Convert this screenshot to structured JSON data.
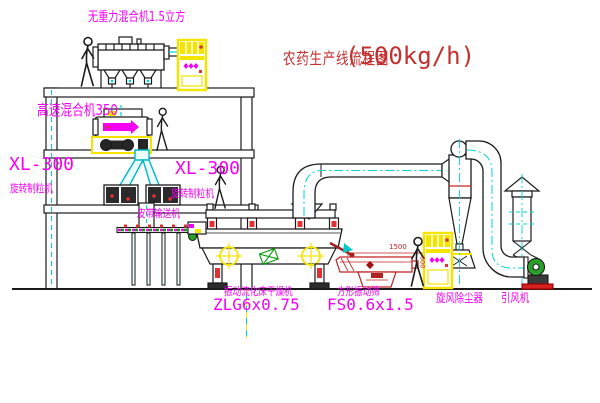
{
  "title": {
    "main": "农药生产线流程图",
    "capacity": "(500kg/h)"
  },
  "labels": {
    "mixer_top": "无重力混合机1.5立方",
    "hs_mixer": "高速混合机350",
    "xl_model_left": "XL-300",
    "xl_name_left": "旋转制粒机",
    "xl_model_right": "XL-300",
    "xl_name_right": "旋转制粒机",
    "belt": "皮带输送机",
    "dryer_name": "振动流化床干燥机",
    "dryer_model": "ZLG6x0.75",
    "sieve_name": "方形振动筛",
    "sieve_model": "FS0.6x1.5",
    "cyclone": "旋风除尘器",
    "fan": "引风机",
    "dim_length": "1500",
    "dim_height": "600"
  },
  "colors": {
    "label_magenta": "#f500f5",
    "title_red": "#c62f2f",
    "cad_cyan": "#00d5d5",
    "cad_yellow": "#f5e400",
    "machine_red": "#e03030",
    "line_black": "#1a1a1a"
  }
}
